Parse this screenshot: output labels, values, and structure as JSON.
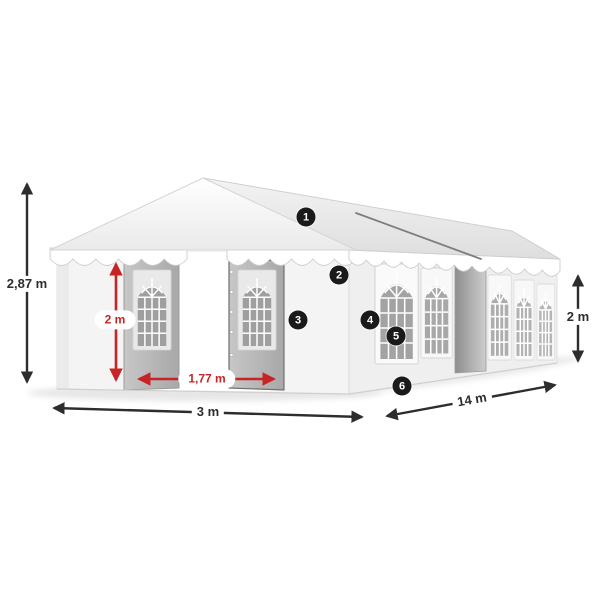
{
  "diagram": {
    "subject": "Party tent / marquee with dimension annotations",
    "background": "#ffffff",
    "colors": {
      "dimension_black": "#2d2d2d",
      "dimension_red": "#c72525",
      "badge_background": "#1a1a1a",
      "badge_text": "#ffffff",
      "tent_white": "#f4f4f4",
      "tent_gray": "#a9a9a9"
    },
    "dimensions": {
      "total_height": {
        "value": "2,87 m",
        "color": "black"
      },
      "door_height": {
        "value": "2 m",
        "color": "red"
      },
      "door_width": {
        "value": "1,77 m",
        "color": "red"
      },
      "front_width": {
        "value": "3 m",
        "color": "black"
      },
      "side_length": {
        "value": "14 m",
        "color": "black"
      },
      "side_height": {
        "value": "2 m",
        "color": "black"
      }
    },
    "callouts": [
      {
        "number": "1"
      },
      {
        "number": "2"
      },
      {
        "number": "3"
      },
      {
        "number": "4"
      },
      {
        "number": "5"
      },
      {
        "number": "6"
      }
    ]
  }
}
